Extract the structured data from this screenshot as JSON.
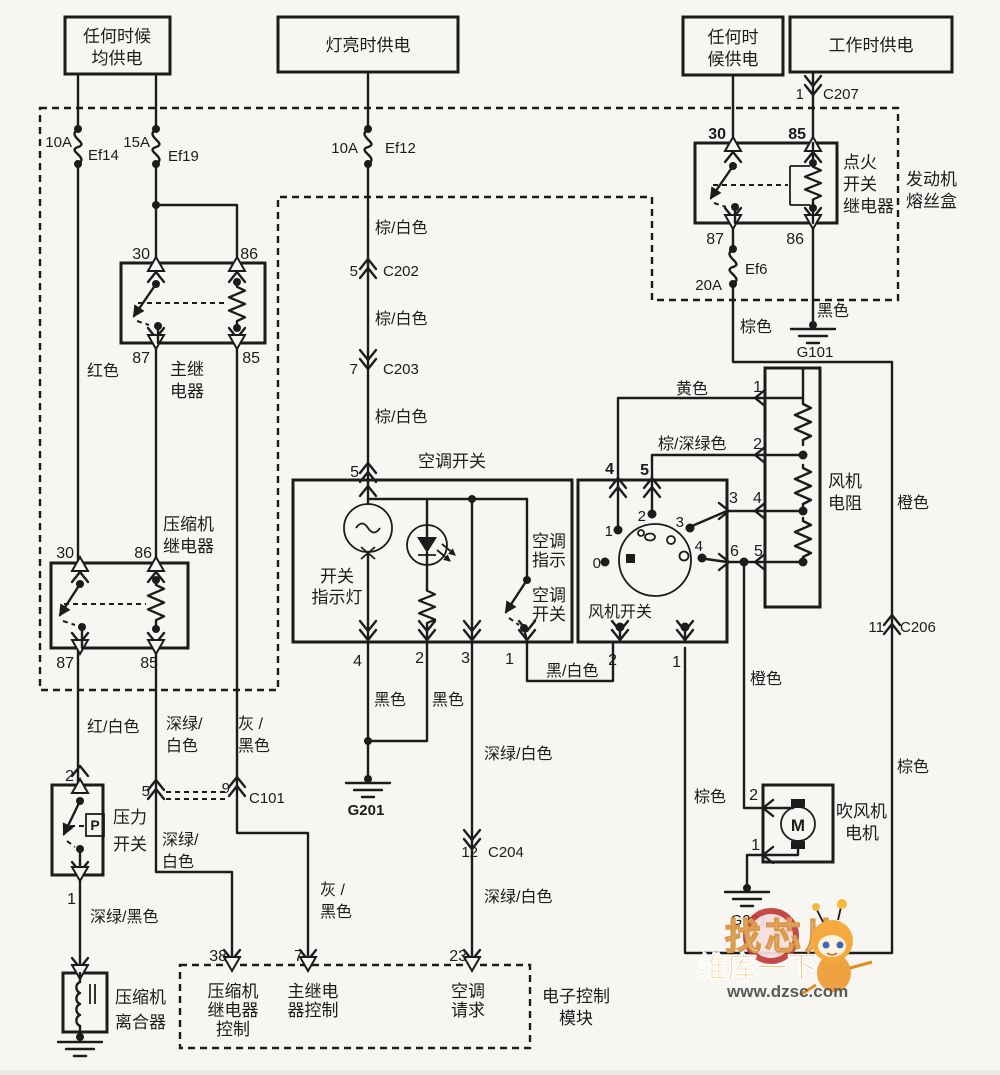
{
  "power_sources": {
    "b1_l1": "任何时候",
    "b1_l2": "均供电",
    "b2": "灯亮时供电",
    "b3_l1": "任何时",
    "b3_l2": "候供电",
    "b4": "工作时供电"
  },
  "fuse_box": {
    "label_l1": "发动机",
    "label_l2": "熔丝盒"
  },
  "fuses": {
    "ef14_amp": "10A",
    "ef14": "Ef14",
    "ef19_amp": "15A",
    "ef19": "Ef19",
    "ef12_amp": "10A",
    "ef12": "Ef12",
    "ef6_amp": "20A",
    "ef6": "Ef6"
  },
  "ignition_relay": {
    "l1": "点火",
    "l2": "开关",
    "l3": "继电器",
    "p30": "30",
    "p85": "85",
    "p87": "87",
    "p86": "86"
  },
  "main_relay": {
    "l1": "主继",
    "l2": "电器",
    "p30": "30",
    "p86": "86",
    "p87": "87",
    "p85": "85"
  },
  "comp_relay": {
    "l1": "压缩机",
    "l2": "继电器",
    "p30": "30",
    "p86": "86",
    "p87": "87",
    "p85": "85"
  },
  "pressure_switch": {
    "l1": "压力",
    "l2": "开关",
    "p": "P",
    "pin2": "2",
    "pin1": "1"
  },
  "clutch": {
    "l1": "压缩机",
    "l2": "离合器"
  },
  "ac_switch": {
    "header": "空调开关",
    "pin5": "5",
    "lamp_l1": "开关",
    "lamp_l2": "指示灯",
    "ind_l1": "空调",
    "ind_l2": "指示",
    "sw_l1": "空调",
    "sw_l2": "开关",
    "pin4": "4",
    "pin2": "2",
    "pin3": "3",
    "pin1": "1"
  },
  "blower_switch": {
    "label": "风机开关",
    "top4": "4",
    "top5": "5",
    "pos0": "0",
    "pos1": "1",
    "pos2": "2",
    "pos3": "3",
    "pos4": "4",
    "r3": "3",
    "r4": "4",
    "r6": "6",
    "r5": "5",
    "bot2": "2",
    "bot1": "1"
  },
  "blower_resistor": {
    "l1": "风机",
    "l2": "电阻",
    "pin1": "1",
    "pin2": "2"
  },
  "blower_motor": {
    "l1": "吹风机",
    "l2": "电机",
    "m": "M",
    "pin2": "2",
    "pin1": "1"
  },
  "ecu": {
    "label_l1": "电子控制",
    "label_l2": "模块",
    "pin38": "38",
    "pin7": "7",
    "pin23": "23",
    "f1_l1": "压缩机",
    "f1_l2": "继电器",
    "f1_l3": "控制",
    "f2_l1": "主继电",
    "f2_l2": "器控制",
    "f3_l1": "空调",
    "f3_l2": "请求"
  },
  "connectors": {
    "c207_pin": "1",
    "c207": "C207",
    "c202_pin": "5",
    "c202": "C202",
    "c203_pin": "7",
    "c203": "C203",
    "c204_pin": "12",
    "c204": "C204",
    "c206_pin": "11",
    "c206": "C206",
    "c101_p5": "5",
    "c101_p9": "9",
    "c101": "C101"
  },
  "grounds": {
    "g101": "G101",
    "g201_ac": "G201",
    "g201_motor": "G201"
  },
  "wires": {
    "red": "红色",
    "brown_white_1": "棕/白色",
    "brown_white_2": "棕/白色",
    "brown_white_3": "棕/白色",
    "black_g101": "黑色",
    "brown_ef6": "棕色",
    "brown_left": "棕色",
    "brown_right": "棕色",
    "yellow": "黄色",
    "brown_dkgreen": "棕/深绿色",
    "orange_right": "橙色",
    "orange_motor": "橙色",
    "red_white": "红/白色",
    "dg_white_a_l1": "深绿/",
    "dg_white_a_l2": "白色",
    "dg_white_b_l1": "深绿/",
    "dg_white_b_l2": "白色",
    "gray_black_a_l1": "灰 /",
    "gray_black_a_l2": "黑色",
    "gray_black_b_l1": "灰 /",
    "gray_black_b_l2": "黑色",
    "dg_black": "深绿/黑色",
    "black_1": "黑色",
    "black_2": "黑色",
    "dg_white_c": "深绿/白色",
    "dg_white_d": "深绿/白色",
    "black_white": "黑/白色"
  },
  "watermark": {
    "t1": "找芯片",
    "t2": "维库一下",
    "t3": "www.dzsc.com"
  },
  "colors": {
    "line": "#1c1c1c",
    "bg": "#f7f6f3",
    "wm_orange": "#ff8a00",
    "wm_red": "#c23b3b"
  }
}
